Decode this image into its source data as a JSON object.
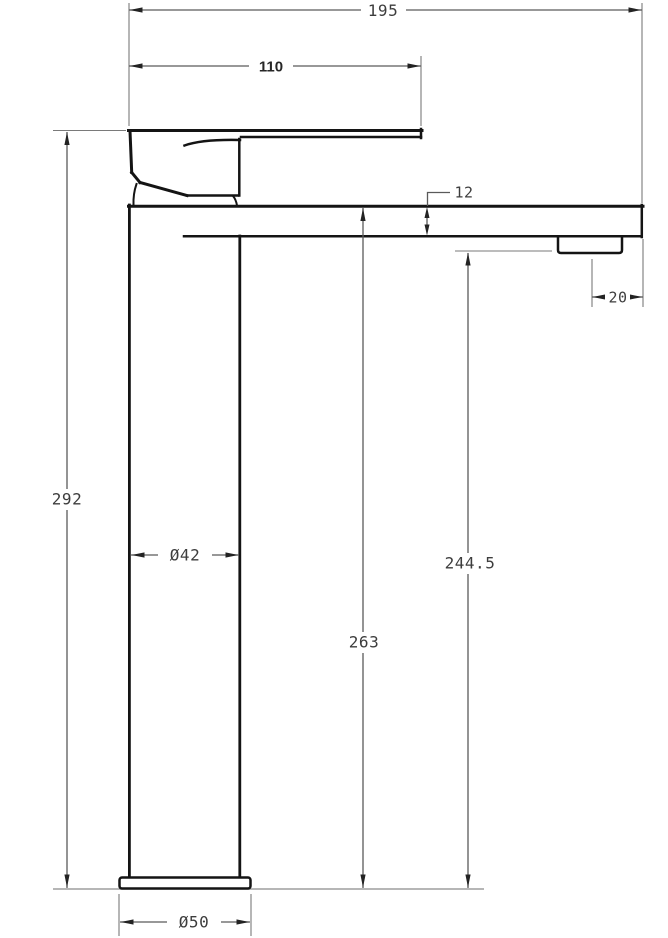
{
  "diagram": {
    "type": "technical-drawing",
    "subject": "Tall basin mixer tap - side elevation with dimensions",
    "unit": "mm",
    "colors": {
      "object_line": "#141414",
      "dimension_line": "#5a5a5a",
      "text": "#3d3d3d",
      "background": "#ffffff"
    },
    "dimensions": {
      "overall_projection": {
        "label": "195",
        "value": 195
      },
      "handle_lever_length": {
        "label": "110",
        "value": 110
      },
      "spout_thickness": {
        "label": "12",
        "value": 12
      },
      "outlet_to_spout_end": {
        "label": "20",
        "value": 20
      },
      "overall_height": {
        "label": "292",
        "value": 292
      },
      "body_diameter": {
        "label": "Ø42",
        "value": 42
      },
      "spout_top_height": {
        "label": "263",
        "value": 263
      },
      "outlet_height": {
        "label": "244.5",
        "value": 244.5
      },
      "base_diameter": {
        "label": "Ø50",
        "value": 50
      }
    }
  }
}
